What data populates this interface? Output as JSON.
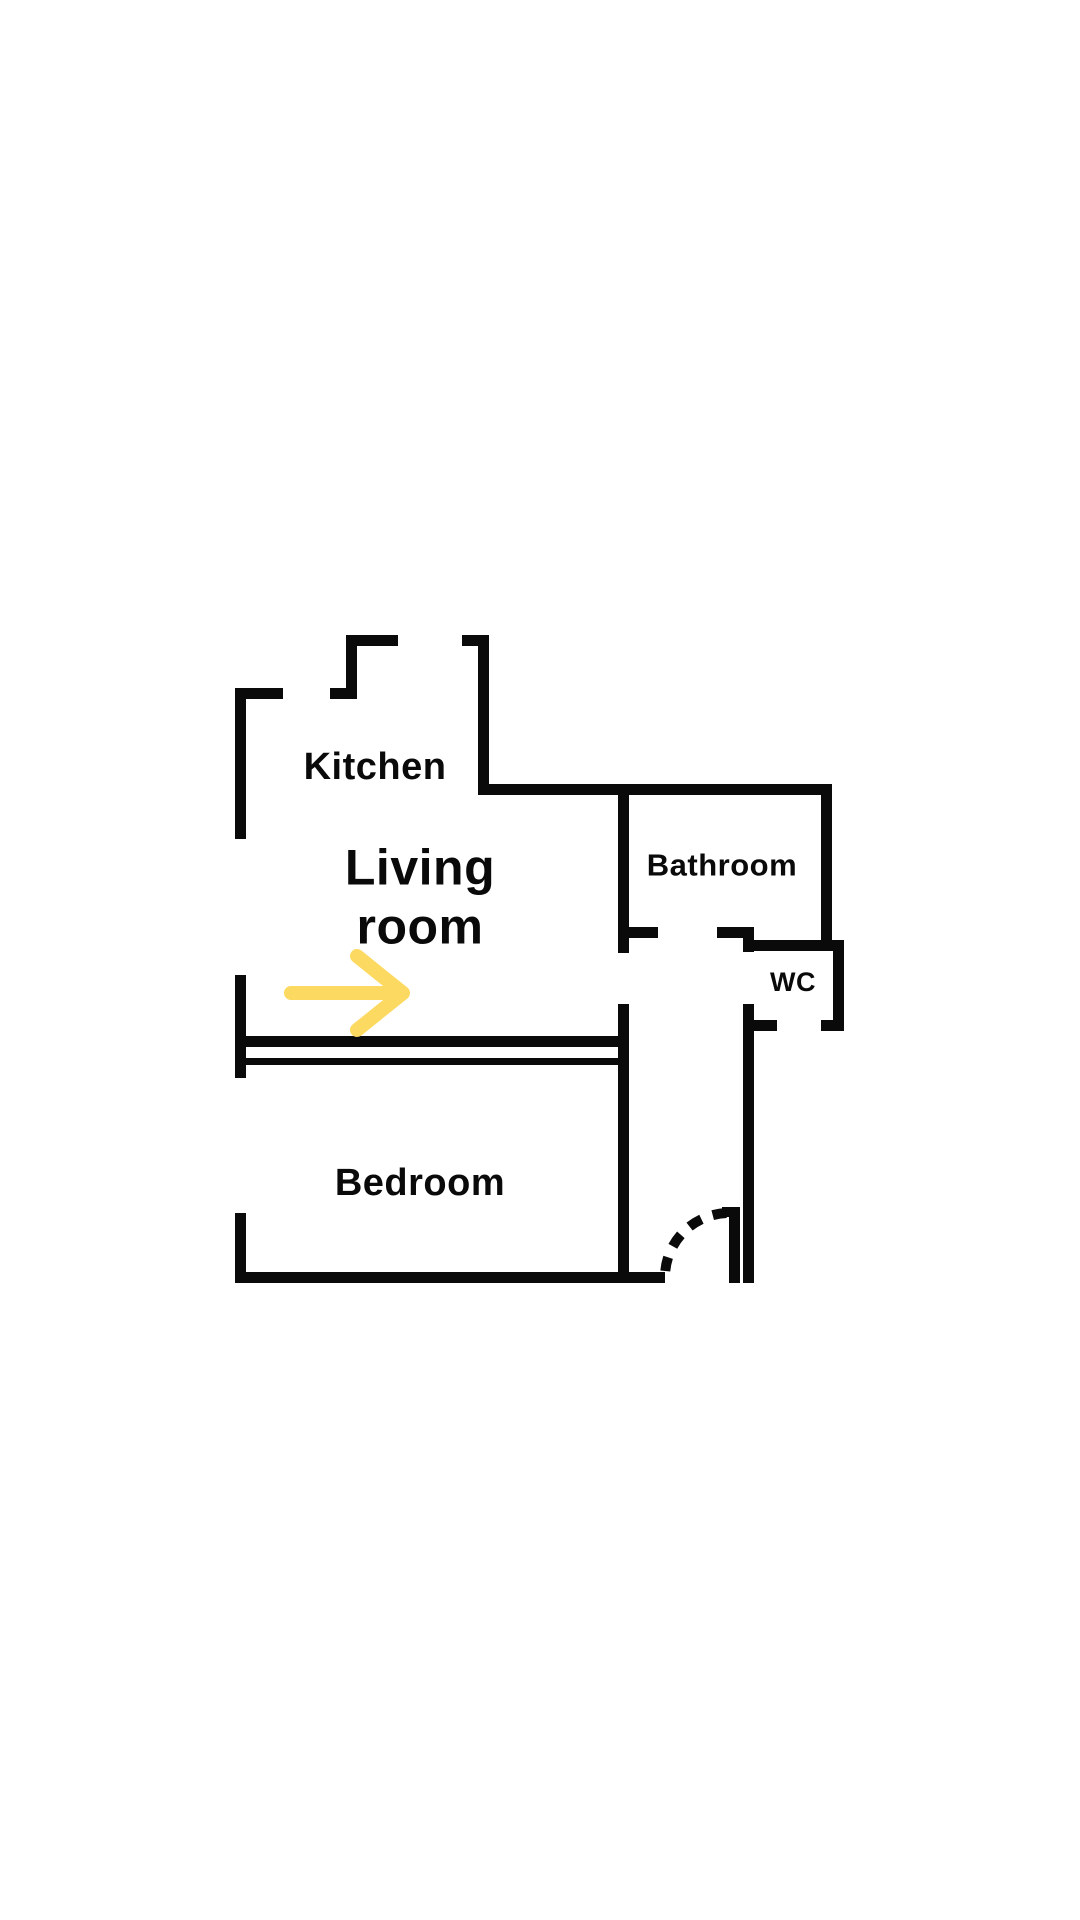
{
  "app": {
    "background_color": "#ffffff",
    "width": 1080,
    "height": 1920
  },
  "floorplan": {
    "wall_color": "#0a0a0a",
    "text_color": "#0a0a0a",
    "rooms": [
      {
        "name": "kitchen",
        "label_lines": [
          "Kitchen"
        ],
        "cx": 375,
        "cy": 767,
        "font_size": 38,
        "line_height": 46
      },
      {
        "name": "living-room",
        "label_lines": [
          "Living",
          "room"
        ],
        "cx": 420,
        "cy": 897,
        "font_size": 50,
        "line_height": 59
      },
      {
        "name": "bathroom",
        "label_lines": [
          "Bathroom"
        ],
        "cx": 722,
        "cy": 865,
        "font_size": 31,
        "line_height": 38
      },
      {
        "name": "wc",
        "label_lines": [
          "WC"
        ],
        "cx": 793,
        "cy": 982,
        "font_size": 27,
        "line_height": 33
      },
      {
        "name": "bedroom",
        "label_lines": [
          "Bedroom"
        ],
        "cx": 420,
        "cy": 1183,
        "font_size": 38,
        "line_height": 46
      }
    ],
    "walls": [
      {
        "name": "kitchen-left-wall",
        "x": 235,
        "y": 688,
        "w": 11,
        "h": 151
      },
      {
        "name": "kitchen-top-wall-left",
        "x": 235,
        "y": 688,
        "w": 48,
        "h": 11
      },
      {
        "name": "kitchen-top-wall-mid",
        "x": 330,
        "y": 688,
        "w": 26,
        "h": 11
      },
      {
        "name": "kitchen-chimney-left-wall",
        "x": 346,
        "y": 635,
        "w": 11,
        "h": 64
      },
      {
        "name": "kitchen-chimney-top-wall",
        "x": 346,
        "y": 635,
        "w": 52,
        "h": 11
      },
      {
        "name": "kitchen-top-wall-right",
        "x": 462,
        "y": 635,
        "w": 27,
        "h": 11
      },
      {
        "name": "kitchen-right-wall",
        "x": 478,
        "y": 635,
        "w": 11,
        "h": 160
      },
      {
        "name": "living-bathroom-top-wall",
        "x": 478,
        "y": 784,
        "w": 354,
        "h": 11
      },
      {
        "name": "bathroom-left-wall",
        "x": 618,
        "y": 795,
        "w": 11,
        "h": 158
      },
      {
        "name": "bathroom-bottom-wall-left",
        "x": 629,
        "y": 927,
        "w": 29,
        "h": 11
      },
      {
        "name": "bathroom-bottom-wall-right",
        "x": 717,
        "y": 927,
        "w": 37,
        "h": 11
      },
      {
        "name": "bathroom-right-wall",
        "x": 821,
        "y": 784,
        "w": 11,
        "h": 157
      },
      {
        "name": "wc-top-wall",
        "x": 743,
        "y": 940,
        "w": 101,
        "h": 11
      },
      {
        "name": "wc-left-jamb",
        "x": 743,
        "y": 938,
        "w": 11,
        "h": 14
      },
      {
        "name": "wc-right-wall",
        "x": 833,
        "y": 940,
        "w": 11,
        "h": 91
      },
      {
        "name": "wc-bottom-wall-right",
        "x": 821,
        "y": 1020,
        "w": 23,
        "h": 11
      },
      {
        "name": "wc-bottom-wall-left",
        "x": 754,
        "y": 1020,
        "w": 23,
        "h": 11
      },
      {
        "name": "hallway-right-wall",
        "x": 743,
        "y": 1004,
        "w": 11,
        "h": 279
      },
      {
        "name": "living-left-wall",
        "x": 235,
        "y": 975,
        "w": 11,
        "h": 103
      },
      {
        "name": "living-bedroom-wall-upper",
        "x": 245,
        "y": 1036,
        "w": 373,
        "h": 11
      },
      {
        "name": "living-bedroom-wall-lower",
        "x": 245,
        "y": 1058,
        "w": 373,
        "h": 7
      },
      {
        "name": "bedroom-right-wall",
        "x": 618,
        "y": 1004,
        "w": 11,
        "h": 279
      },
      {
        "name": "bedroom-left-wall",
        "x": 235,
        "y": 1213,
        "w": 11,
        "h": 70
      },
      {
        "name": "bedroom-bottom-wall",
        "x": 235,
        "y": 1272,
        "w": 430,
        "h": 11
      },
      {
        "name": "bedroom-door-jamb",
        "x": 729,
        "y": 1207,
        "w": 11,
        "h": 76
      },
      {
        "name": "bedroom-door-jamb-tab",
        "x": 722,
        "y": 1207,
        "w": 18,
        "h": 10
      }
    ],
    "door_swing": {
      "name": "bedroom-door-swing-arc",
      "start": [
        665,
        1277
      ],
      "end": [
        729,
        1213
      ],
      "radius": 64,
      "stroke_width": 10,
      "dash": "14 12",
      "dash_offset": 20
    },
    "arrow": {
      "name": "direction-arrow-right",
      "color": "#FCD960",
      "stroke_width": 14,
      "shaft": {
        "x1": 291,
        "y1": 993,
        "x2": 399,
        "y2": 993
      },
      "head": [
        [
          357,
          956
        ],
        [
          403,
          993
        ],
        [
          357,
          1030
        ]
      ]
    }
  }
}
